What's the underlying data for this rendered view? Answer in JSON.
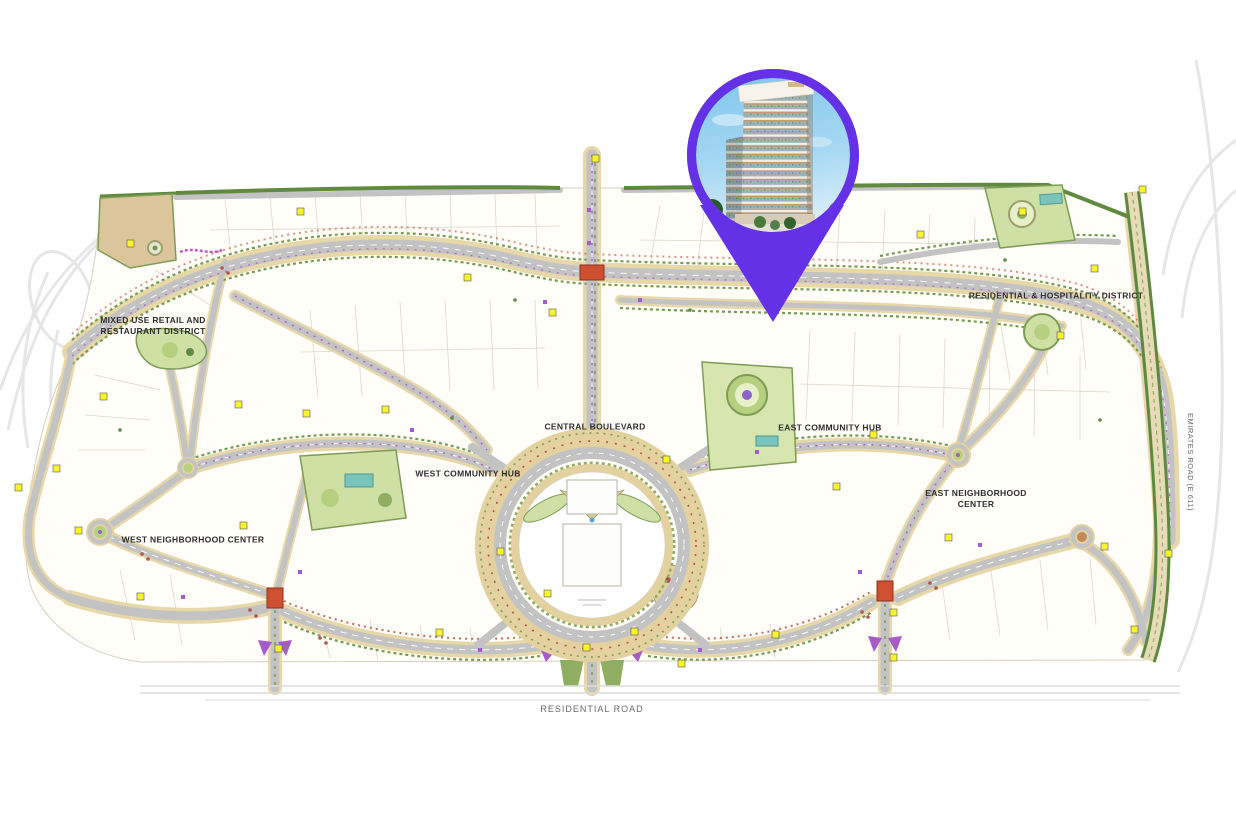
{
  "map": {
    "labels": {
      "mixed_use": "MIXED USE RETAIL AND RESTAURANT DISTRICT",
      "central_boulevard": "CENTRAL BOULEVARD",
      "west_community_hub": "WEST COMMUNITY HUB",
      "east_community_hub": "EAST COMMUNITY HUB",
      "west_neighborhood_center": "WEST NEIGHBORHOOD CENTER",
      "east_neighborhood_center": "EAST NEIGHBORHOOD CENTER",
      "residential_hospitality": "RESIDENTIAL & HOSPITALITY DISTRICT",
      "residential_road": "RESIDENTIAL ROAD",
      "emirates_road": "EMIRATES ROAD (E 611)"
    },
    "colors": {
      "road_gray": "#c3c3c3",
      "sand": "#e3d1a0",
      "hedge_green": "#749b50",
      "lawn_green": "#cfe0a4",
      "marker_yellow": "#f8f32a",
      "junction_red": "#cf5030",
      "accent_purple": "#a55cc8",
      "pin_purple": "#6431e7"
    }
  },
  "pin": {
    "label": "project-location",
    "color": "#6431e7",
    "photo": "residential-tower-photo"
  }
}
